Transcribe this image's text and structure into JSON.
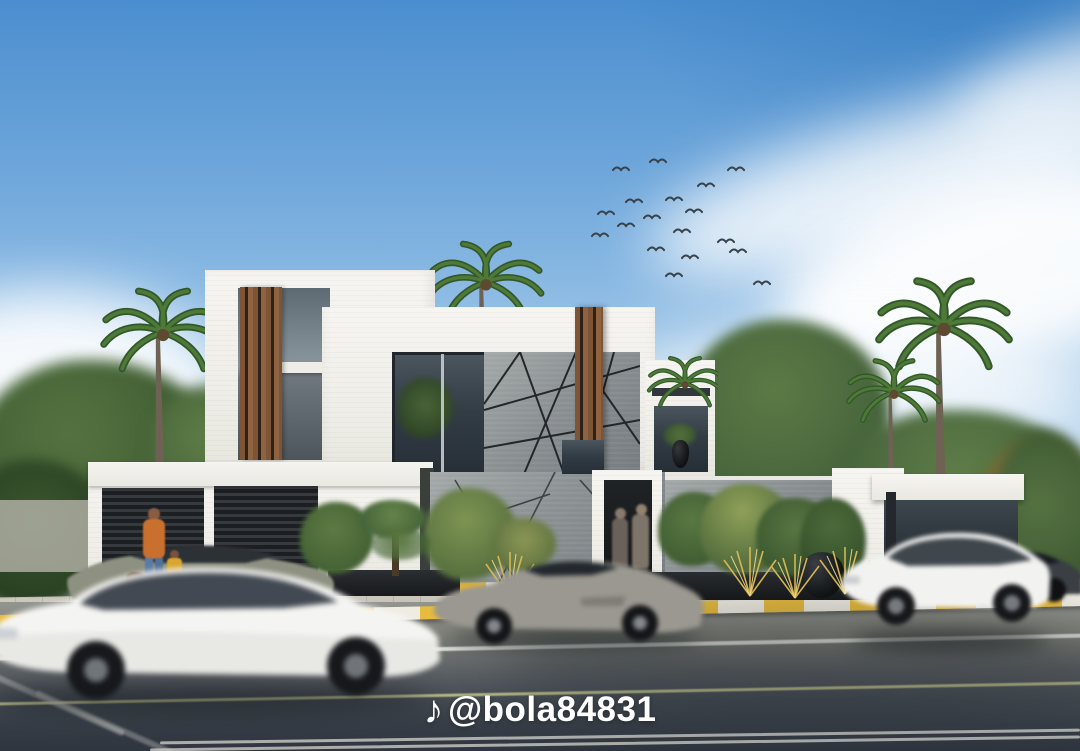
{
  "watermark": {
    "icon": "music-note",
    "icon_glyph": "♪",
    "handle": "@bola84831"
  },
  "palette": {
    "sky_top": "#4b8ecf",
    "sky_horizon": "#eef4f9",
    "cloud_white": "#ffffff",
    "wall_white": "#f2f1ec",
    "wood_accent": "#7d5435",
    "stone_gray": "#8b9193",
    "glass_dark": "#333d46",
    "roller_door_dark": "#1c1f22",
    "curb_yellow": "#e7bb3e",
    "road_asphalt_near": "#2e343d",
    "road_asphalt_far": "#93958f",
    "foliage_green": "#4f6f3e",
    "ornamental_grass_gold": "#dcbb55",
    "shirt_orange": "#c9702f",
    "jeans_blue": "#5a7ba6",
    "car_white": "#f4f4f2",
    "car_gray": "#9a9890",
    "car_olive": "#8e9181"
  },
  "scene": {
    "subject": "modern-two-story-villa-street-view",
    "objects": [
      "blue-sky-with-clouds",
      "flock-of-birds",
      "palm-trees",
      "background-trees",
      "white-villa-with-wood-slats",
      "gray-stone-feature-panel-with-diagonal-seams",
      "garage-roller-doors",
      "entrance-door",
      "boundary-stone-wall",
      "glass-pavilion-carport",
      "topiary-garden-with-golden-grasses",
      "black-planter-pots",
      "striped-curbs",
      "asphalt-road-with-lane-markings",
      "white-suv-motion-blur-left",
      "olive-sedan-parked",
      "gray-sports-car-motion-blur",
      "white-suv-motion-blur-right",
      "dark-car-in-carport",
      "man-with-children-on-sidewalk",
      "two-people-at-entrance"
    ]
  }
}
